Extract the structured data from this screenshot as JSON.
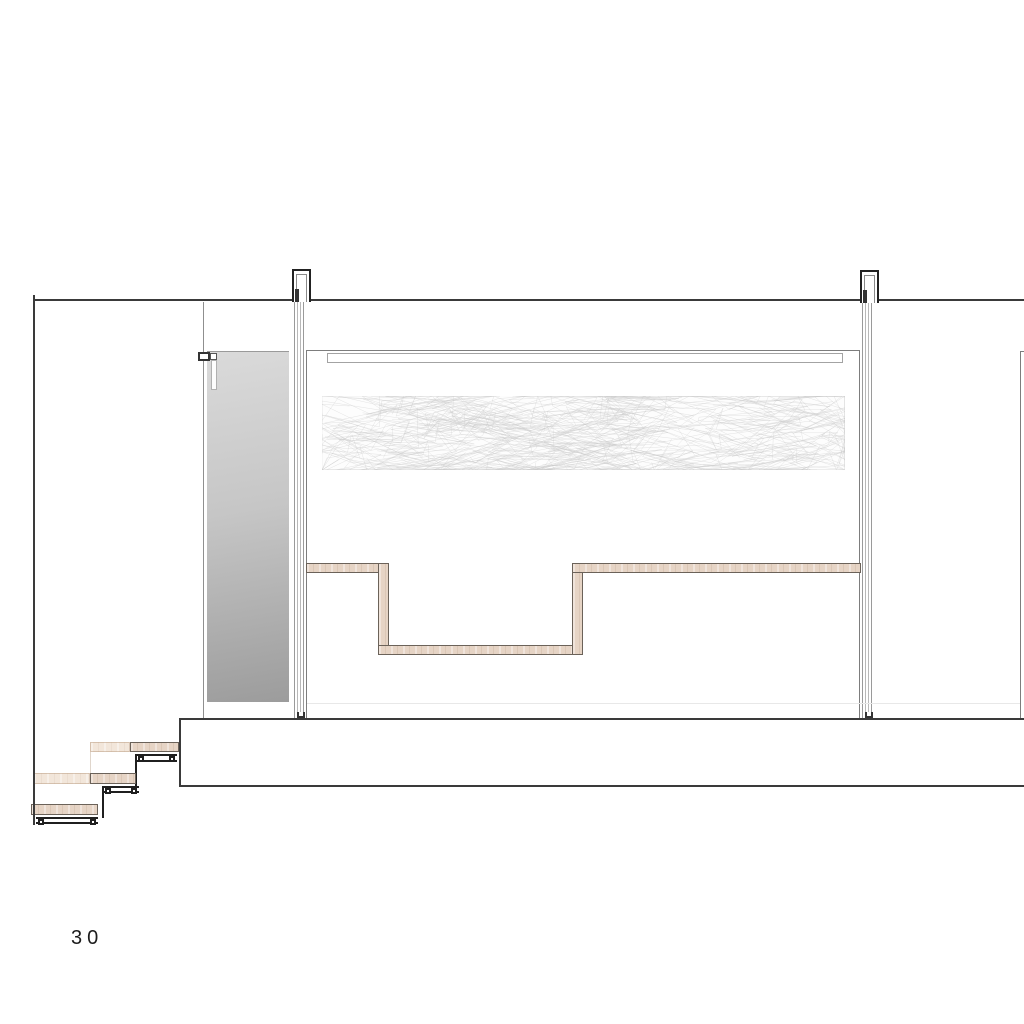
{
  "page": {
    "number_label": "30"
  },
  "drawing": {
    "kind": "architectural-section",
    "colors": {
      "line_dark": "#3a3a3a",
      "line_medium": "#7d7d7d",
      "line_glass": "#8f8f8f",
      "line_faint": "#e8e8e8",
      "mullion": "#b8b8b8",
      "steel": "#1f1f1f",
      "wood_fill": "#e6d4c5",
      "wood_light": "#f2e6da",
      "wood_outline": "#6b6259",
      "mirror_top": "#dadada",
      "mirror_bottom": "#9c9c9c",
      "texture_stroke": "#c9c9c9",
      "paper": "#ffffff"
    }
  }
}
